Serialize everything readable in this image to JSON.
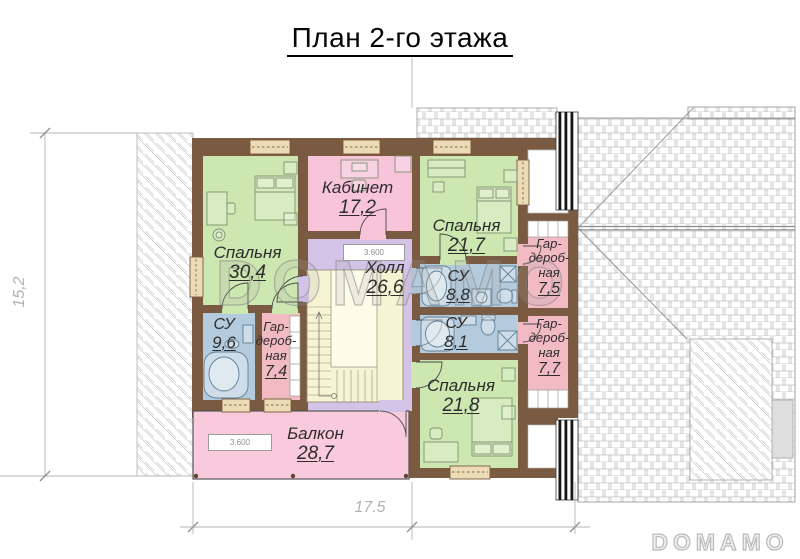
{
  "title": "План 2-го этажа",
  "watermark": {
    "text": "DOMAMO"
  },
  "dimensions": {
    "width": "17.5",
    "height": "15,2"
  },
  "elevation_marks": {
    "hall": "3.600",
    "balcony": "3.600"
  },
  "rooms": [
    {
      "id": "bedroom-1",
      "name": "Спальня",
      "area": "30,4"
    },
    {
      "id": "office",
      "name": "Кабинет",
      "area": "17,2"
    },
    {
      "id": "bedroom-2",
      "name": "Спальня",
      "area": "21,7"
    },
    {
      "id": "hall",
      "name": "Холл",
      "area": "26,6"
    },
    {
      "id": "bathroom-1",
      "name": "СУ",
      "area": "8,8"
    },
    {
      "id": "wardrobe-1",
      "name": "Гар-\nдероб-\nная",
      "area": "7,5"
    },
    {
      "id": "bathroom-2",
      "name": "СУ",
      "area": "8,1"
    },
    {
      "id": "wardrobe-2",
      "name": "Гар-\nдероб-\nная",
      "area": "7,7"
    },
    {
      "id": "bathroom-3",
      "name": "СУ",
      "area": "9,6"
    },
    {
      "id": "wardrobe-3",
      "name": "Гар-\nдероб-\nная",
      "area": "7,4"
    },
    {
      "id": "bedroom-3",
      "name": "Спальня",
      "area": "21,8"
    },
    {
      "id": "balcony",
      "name": "Балкон",
      "area": "28,7"
    }
  ],
  "palette": {
    "wall": "#7a5a41",
    "bedroom": "#cde7b0",
    "office": "#f7c4da",
    "hall": "#d3c3e7",
    "bathroom": "#b4cbdd",
    "wardrobe": "#f2bac3",
    "balcony": "#f9c9dc",
    "stairs": "#f7f4d3",
    "window": "#ecdbb4"
  }
}
